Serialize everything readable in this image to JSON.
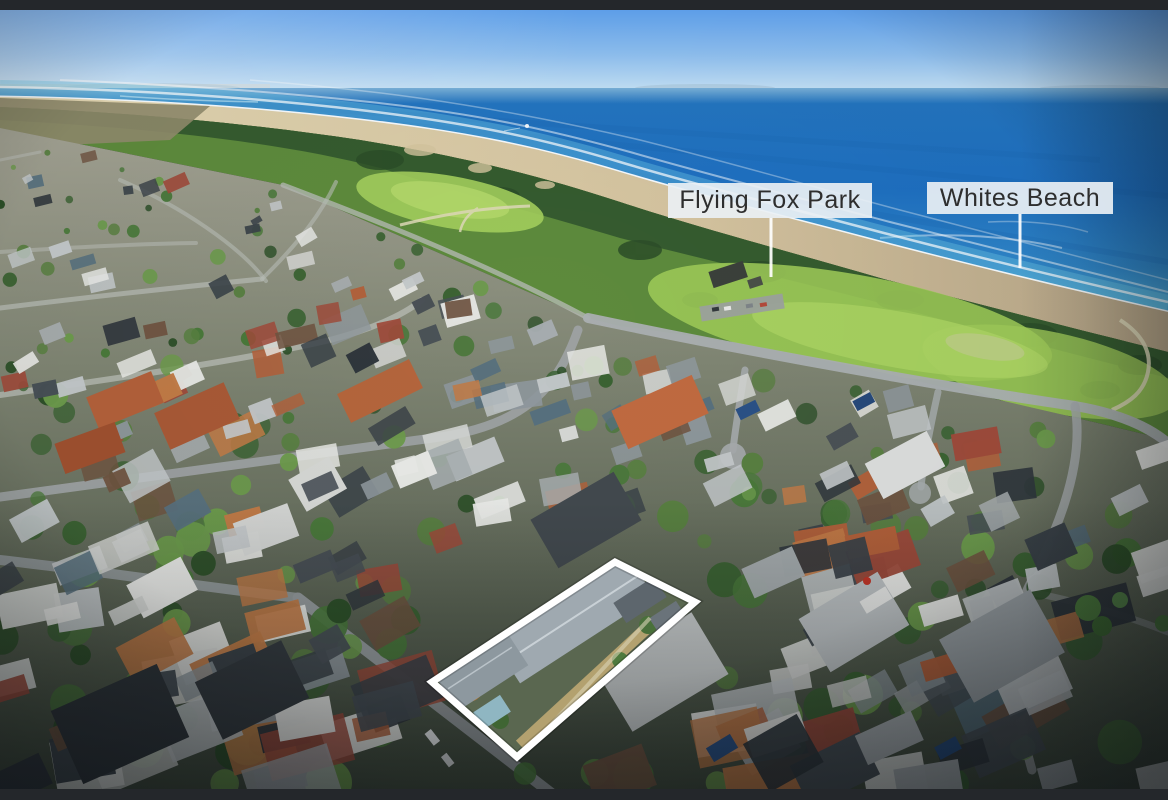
{
  "scene": {
    "annotations": {
      "park_label": "Flying Fox Park",
      "beach_label": "Whites Beach"
    },
    "colors": {
      "letterbox": "#24272b",
      "label_background": "#eaf0f4",
      "label_text": "#2e2e2e",
      "leader_line": "#ffffff",
      "property_outline": "#ffffff",
      "sky_top": "#60a2ee",
      "sky_horizon": "#c6e2f6",
      "ocean_deep": "#1e6fc0",
      "ocean_shallow": "#51aed8",
      "surf_foam": "#ffffff",
      "beach_sand": "#d8c9a4",
      "dune_vegetation": "#33582e",
      "park_grass": "#9dc958",
      "road_gray": "#aaafb1",
      "roof_terracotta": "#b2603a",
      "roof_dark_slate": "#3a4248",
      "roof_light_gray": "#c9cdcd",
      "highlight_roof": "#9fa9b0"
    }
  }
}
